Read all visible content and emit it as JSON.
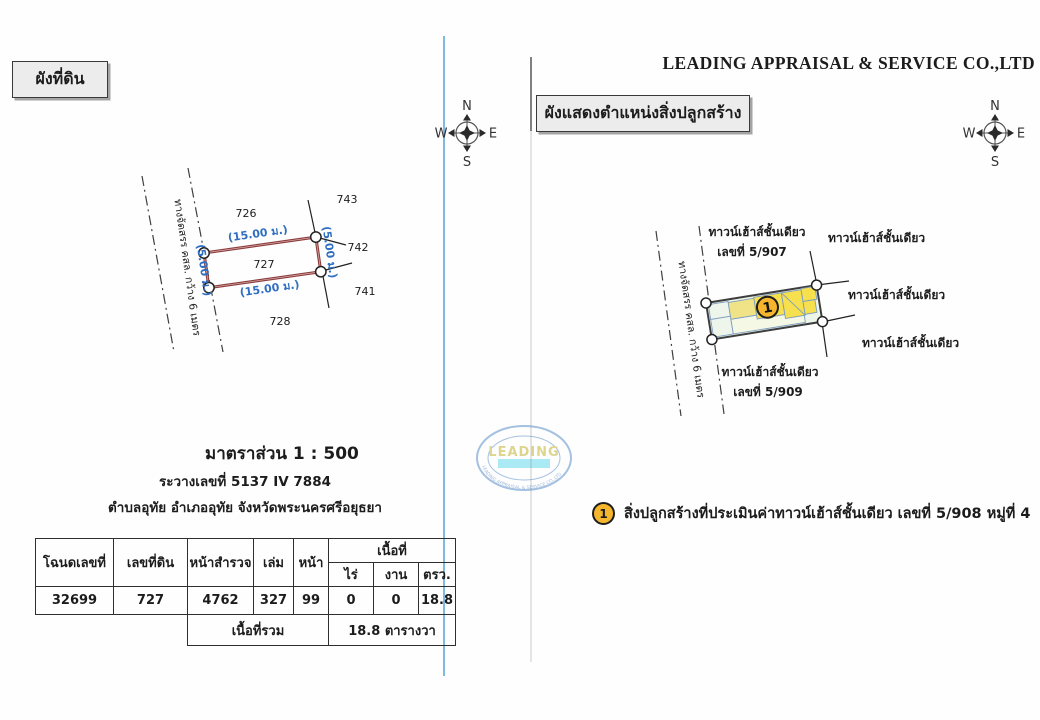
{
  "header": {
    "company": "LEADING APPRAISAL & SERVICE CO.,LTD"
  },
  "compass": {
    "n": "N",
    "e": "E",
    "s": "S",
    "w": "W"
  },
  "left": {
    "title": "ผังที่ดิน",
    "road_label": "ทางจัดสรร คสล. กว้าง 6 เมตร",
    "plot_number": "727",
    "dims": {
      "top": "(15.00 ม.)",
      "bottom": "(15.00 ม.)",
      "left": "(5.00 ม.)",
      "right": "(5.00 ม.)"
    },
    "neighbors": {
      "top": "726",
      "top_right": "743",
      "right": "742",
      "bottom_right": "741",
      "bottom": "728"
    },
    "scale": "มาตราส่วน 1 : 500",
    "sheet": "ระวางเลขที่ 5137 IV 7884",
    "location": "ตำบลอุทัย อำเภออุทัย จังหวัดพระนครศรีอยุธยา",
    "table": {
      "h_deed": "โฉนดเลขที่",
      "h_parcel": "เลขที่ดิน",
      "h_survey": "หน้าสำรวจ",
      "h_volume": "เล่ม",
      "h_page": "หน้า",
      "h_area": "เนื้อที่",
      "h_rai": "ไร่",
      "h_ngan": "งาน",
      "h_wah": "ตรว.",
      "deed": "32699",
      "parcel": "727",
      "survey": "4762",
      "volume": "327",
      "page": "99",
      "rai": "0",
      "ngan": "0",
      "wah": "18.8",
      "total_label": "เนื้อที่รวม",
      "total_value": "18.8 ตารางวา"
    }
  },
  "right": {
    "title": "ผังแสดงตำแหน่งสิ่งปลูกสร้าง",
    "road_label": "ทางจัดสรร คสล. กว้าง 6 เมตร",
    "marker": "1",
    "labels": {
      "top_line1": "ทาวน์เฮ้าส์ชั้นเดียว",
      "top_line2": "เลขที่ 5/907",
      "top_right": "ทาวน์เฮ้าส์ชั้นเดียว",
      "right": "ทาวน์เฮ้าส์ชั้นเดียว",
      "bottom_right": "ทาวน์เฮ้าส์ชั้นเดียว",
      "bottom_line1": "ทาวน์เฮ้าส์ชั้นเดียว",
      "bottom_line2": "เลขที่ 5/909"
    },
    "legend_marker": "1",
    "legend_text": "สิ่งปลูกสร้างที่ประเมินค่าทาวน์เฮ้าส์ชั้นเดียว เลขที่ 5/908 หมู่ที่ 4"
  },
  "watermark": {
    "name": "LEADING",
    "ring_text": "LEADING APPRAISAL & SERVICE CO.,LTD"
  },
  "colors": {
    "plot_outline": "#8a3b3b",
    "dimension_text": "#2f6ec2",
    "divider_blue": "#5fa8dc",
    "building_yellow": "#f7e04d",
    "building_pale": "#f0e387",
    "plot_fill": "#edf5e8",
    "marker_fill": "#f5b62e"
  }
}
